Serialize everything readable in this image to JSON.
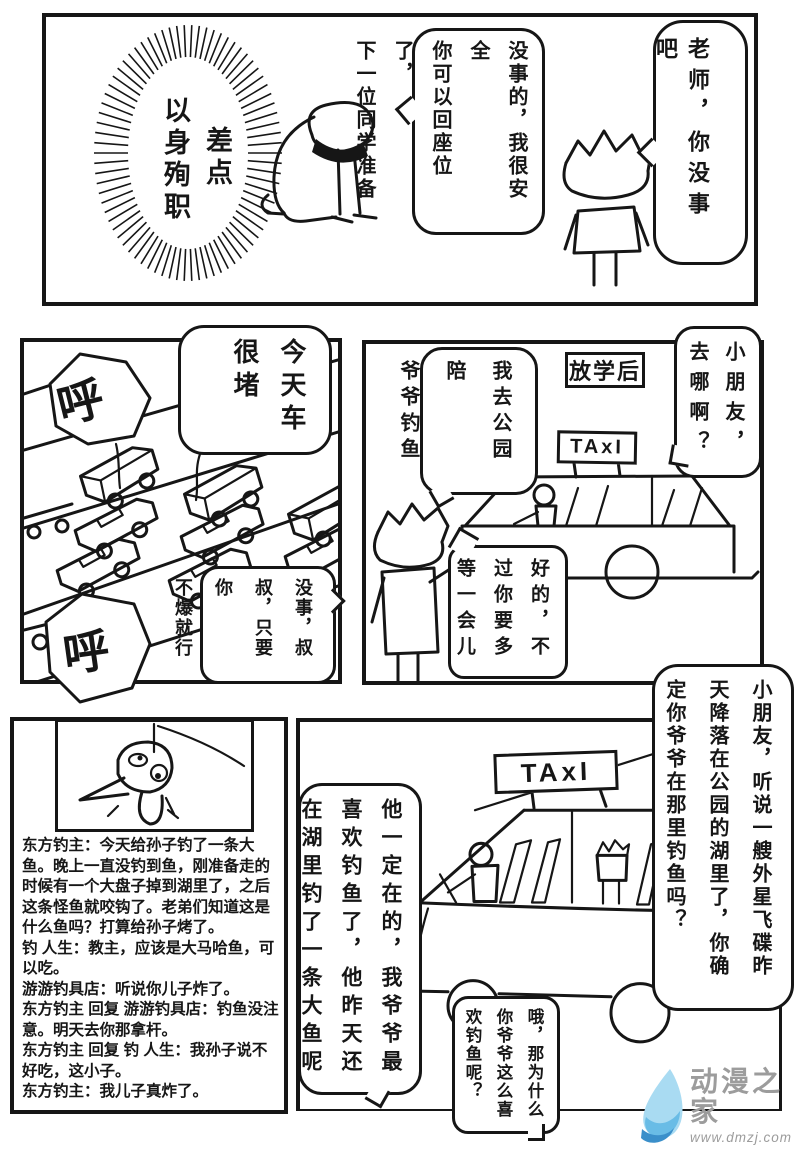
{
  "page": {
    "background": "#ffffff",
    "ink": "#161616"
  },
  "panel_classroom": {
    "scream_sfx": [
      "差点",
      "以身殉职"
    ],
    "teacher_bubble": [
      "没事的，我很安全",
      "你可以回座位了，",
      "下一位同学准备"
    ],
    "student_bubble": [
      "老师，你没事吧"
    ]
  },
  "panel_traffic": {
    "sigh_sfx_top": "呼",
    "sigh_sfx_bottom": "呼",
    "jam_bubble": [
      "今天车",
      "很堵"
    ],
    "passenger_bubble": [
      "没事，叔",
      "叔，只要你",
      "不爆就行"
    ]
  },
  "panel_taxi_stop": {
    "scene_caption": "放学后",
    "taxi_sign": "TAxI",
    "boy_bubble": [
      "我去公园陪",
      "爷爷钓鱼"
    ],
    "driver_bubble": [
      "小朋友，",
      "去哪啊？"
    ],
    "driver_ok_bubble": [
      "好的，不",
      "过你要多",
      "等一会儿"
    ]
  },
  "panel_fish_post": {
    "comments": [
      "东方钓主：今天给孙子钓了一条大鱼。晚上一直没钓到鱼，刚准备走的时候有一个大盘子掉到湖里了，之后这条怪鱼就咬钩了。老弟们知道这是什么鱼吗？打算给孙子烤了。",
      "钓 人生：教主，应该是大马哈鱼，可以吃。",
      "游游钓具店：听说你儿子炸了。",
      "东方钓主 回复 游游钓具店：钓鱼没注意。明天去你那拿杆。",
      "东方钓主 回复 钓 人生：我孙子说不好吃，这小子。",
      "东方钓主：我儿子真炸了。"
    ]
  },
  "panel_taxi_ride": {
    "taxi_sign": "TAxI",
    "driver_alien_bubble": [
      "小朋友，听说一艘外星飞碟昨",
      "天降落在公园的湖里了，你确",
      "定你爷爷在那里钓鱼吗？"
    ],
    "boy_reply_bubble": [
      "他一定在的，我爷爷最",
      "喜欢钓鱼了，他昨天还",
      "在湖里钓了一条大鱼呢"
    ],
    "driver_why_bubble": [
      "哦，那为什么",
      "你爷爷这么喜",
      "欢钓鱼呢？"
    ]
  },
  "watermark": {
    "brand": "动漫之家",
    "url": "www.dmzj.com",
    "text_color": "#9c9c9c",
    "logo_blue_light": "#a9dbf2",
    "logo_blue_mid": "#69bce6",
    "logo_blue_dark": "#3a8fca"
  }
}
